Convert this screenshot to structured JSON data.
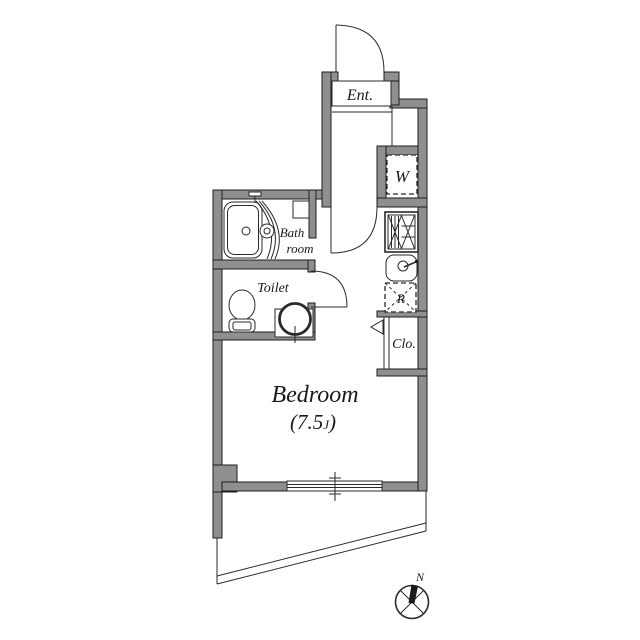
{
  "floor_plan": {
    "labels": {
      "entrance": "Ent.",
      "washer": "W",
      "bath_line1": "Bath",
      "bath_line2": "room",
      "toilet": "Toilet",
      "refrigerator": "R",
      "closet": "Clo.",
      "bedroom": "Bedroom",
      "bedroom_size_open": "(7.5",
      "bedroom_size_unit": "J",
      "bedroom_size_close": ")",
      "compass_north": "N"
    },
    "colors": {
      "wall": "#8f8f8f",
      "wall_outline": "#1c1c1c",
      "line": "#2a2a2a",
      "background": "#ffffff",
      "text": "#1a1a1a"
    }
  }
}
